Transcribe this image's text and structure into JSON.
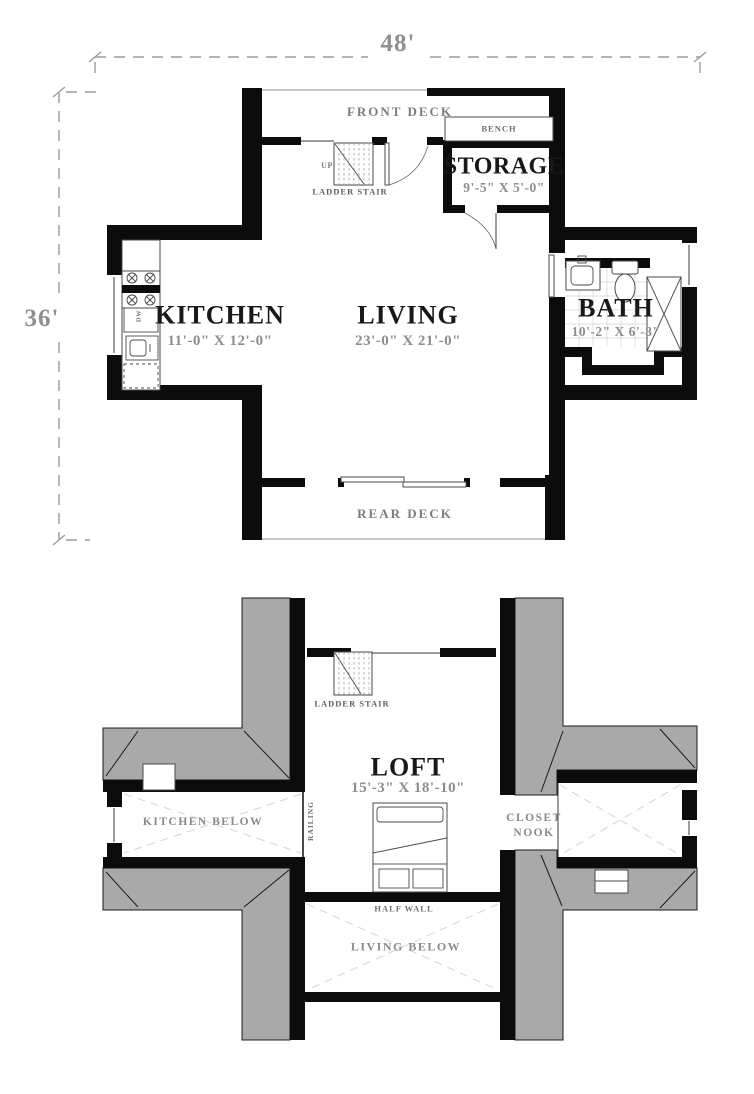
{
  "title": "Two-level cabin floor plan",
  "dimensions": {
    "width": "48'",
    "depth": "36'"
  },
  "first_floor": {
    "rooms": {
      "kitchen": {
        "name": "KITCHEN",
        "size": "11'-0\" X 12'-0\""
      },
      "living": {
        "name": "LIVING",
        "size": "23'-0\" X 21'-0\""
      },
      "bath": {
        "name": "BATH",
        "size": "10'-2\" X 6'-8\""
      },
      "storage": {
        "name": "STORAGE",
        "size": "9'-5\" X 5'-0\""
      }
    },
    "labels": {
      "front_deck": "FRONT DECK",
      "rear_deck": "REAR DECK",
      "bench": "BENCH",
      "up": "UP",
      "ladder_stair": "LADDER STAIR",
      "dishwasher": "DW"
    }
  },
  "second_floor": {
    "rooms": {
      "loft": {
        "name": "LOFT",
        "size": "15'-3\" X 18'-10\""
      }
    },
    "labels": {
      "ladder_stair": "LADDER STAIR",
      "kitchen_below": "KITCHEN BELOW",
      "railing": "RAILING",
      "closet_line1": "CLOSET",
      "closet_line2": "NOOK",
      "half_wall": "HALF WALL",
      "living_below": "LIVING BELOW"
    }
  },
  "colors": {
    "wall": "#0c0c0c",
    "roof": "#a9a9a9",
    "dim_line": "#9b9b9b",
    "dim_text": "#8f8f8f",
    "gray_label": "#7d7d7d",
    "room_text": "#181818"
  }
}
